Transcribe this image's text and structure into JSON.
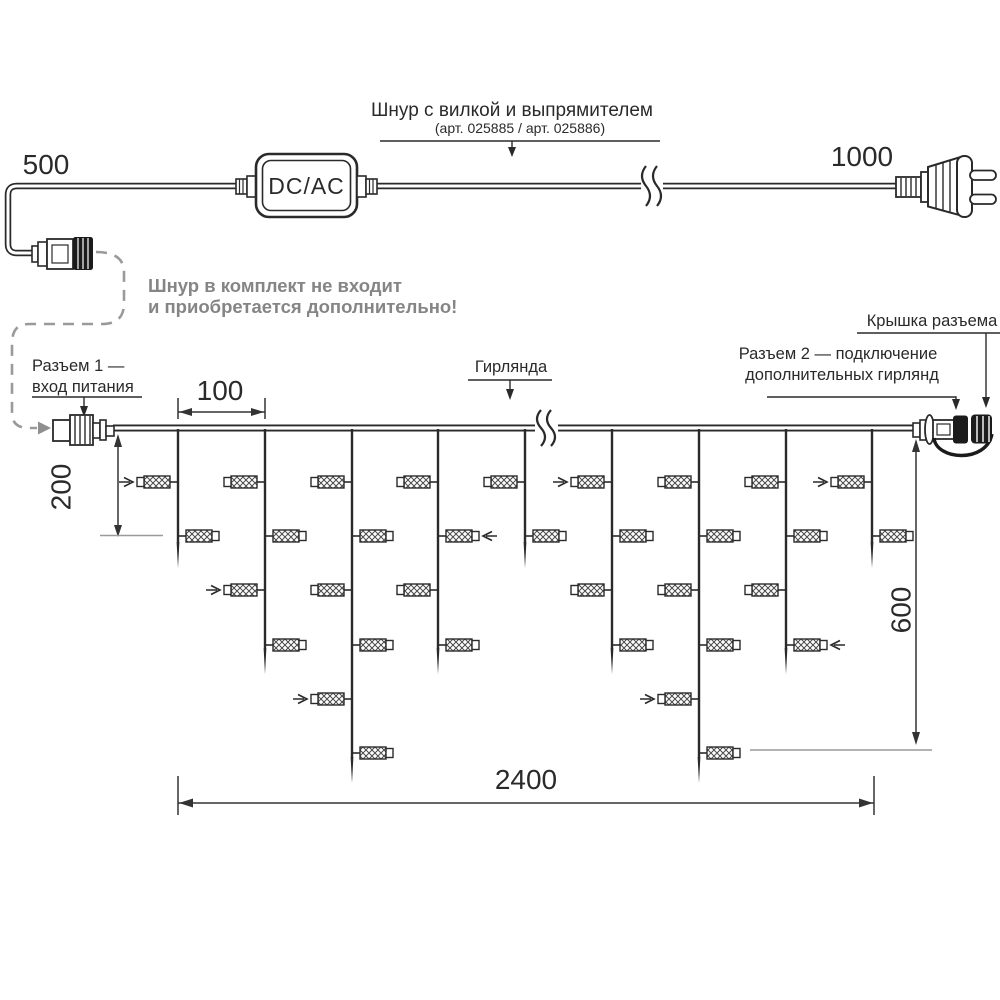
{
  "diagram": {
    "power_cord": {
      "left_length": "500",
      "right_length": "1000",
      "converter": "DC/AC",
      "callout_title": "Шнур с вилкой и выпрямителем",
      "callout_subtitle": "(арт. 025885 /  арт. 025886)"
    },
    "note": {
      "line1": "Шнур в комплект не входит",
      "line2": "и приобретается дополнительно!"
    },
    "labels": {
      "connector1_line1": "Разъем 1 —",
      "connector1_line2": "вход питания",
      "garland": "Гирлянда",
      "connector2_line1": "Разъем 2 — подключение",
      "connector2_line2": "дополнительных гирлянд",
      "cap": "Крышка разъема"
    },
    "dimensions": {
      "spacing": "100",
      "first_level": "200",
      "max_drop": "600",
      "total": "2400"
    },
    "garland": {
      "wire_y": 428,
      "drops": [
        {
          "x": 178,
          "size": "short"
        },
        {
          "x": 265,
          "size": "medium"
        },
        {
          "x": 352,
          "size": "long"
        },
        {
          "x": 438,
          "size": "medium"
        },
        {
          "x": 525,
          "size": "short"
        },
        {
          "x": 612,
          "size": "medium"
        },
        {
          "x": 699,
          "size": "long"
        },
        {
          "x": 786,
          "size": "medium"
        },
        {
          "x": 872,
          "size": "short"
        }
      ],
      "sizes": {
        "short": {
          "rows": 2,
          "bottom": 568
        },
        "medium": {
          "rows": 4,
          "bottom": 674
        },
        "long": {
          "rows": 6,
          "bottom": 783
        }
      },
      "row_y": [
        482,
        536,
        590,
        645,
        699,
        753
      ],
      "arrows": [
        [
          0,
          1
        ],
        [
          1,
          3
        ],
        [
          2,
          5
        ],
        [
          3,
          2
        ],
        [
          5,
          1
        ],
        [
          6,
          5
        ],
        [
          7,
          4
        ],
        [
          8,
          1
        ]
      ]
    },
    "colors": {
      "line": "#2a2a2a",
      "dim": "#333333",
      "gray": "#9a9a9a",
      "gray_text": "#858585",
      "black_fill": "#1b1b1b"
    }
  }
}
